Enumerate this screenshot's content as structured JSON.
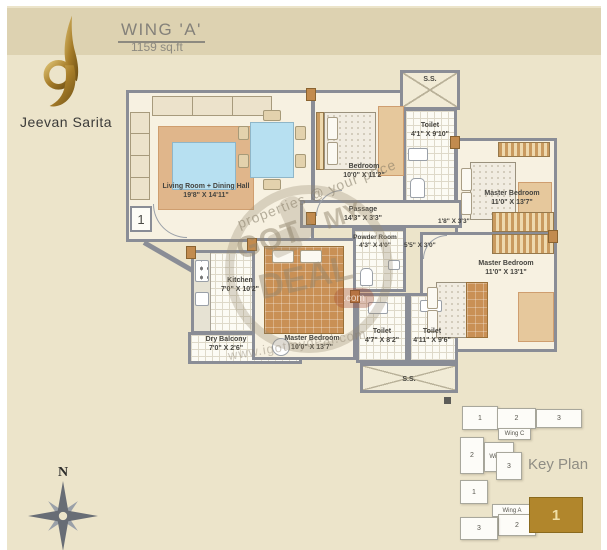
{
  "header": {
    "wing_title": "WING 'A'",
    "area": "1159 sq.ft"
  },
  "brand": {
    "name": "Jeevan Sarita"
  },
  "plan": {
    "rooms": [
      {
        "name": "Living Room + Dining Hall",
        "dims": "19'8\" X 14'11\""
      },
      {
        "name": "Bedroom",
        "dims": "10'0\" X 11'2\""
      },
      {
        "name": "Toilet",
        "dims": "4'1\" X 9'10\""
      },
      {
        "name": "Master Bedroom",
        "dims": "11'0\" X 13'7\""
      },
      {
        "name": "Passage",
        "dims": "14'3\" X 3'3\""
      },
      {
        "name": "Master Bedroom",
        "dims": "11'0\" X 13'1\""
      },
      {
        "name": "Powder Room",
        "dims": "4'3\" X 4'0\""
      },
      {
        "name": "Kitchen",
        "dims": "7'0\" X 10'2\""
      },
      {
        "name": "Dry Balcony",
        "dims": "7'0\" X 2'6\""
      },
      {
        "name": "Master Bedroom",
        "dims": "10'0\" X 13'7\""
      },
      {
        "name": "Toilet",
        "dims": "4'7\" X 8'2\""
      },
      {
        "name": "Toilet",
        "dims": "4'11\" X 9'6\""
      }
    ],
    "shafts": {
      "top": "S.S.",
      "bottom": "S.S."
    },
    "entrance_number": "1",
    "extra_dims": [
      "1'8\" X 3'3\"",
      "5'5\" X 3'0\""
    ]
  },
  "compass": {
    "north": "N"
  },
  "key_plan": {
    "title": "Key Plan",
    "blocks": [
      {
        "label": "1"
      },
      {
        "label": "2"
      },
      {
        "label": "3"
      },
      {
        "label": "Wing C"
      },
      {
        "label": "2"
      },
      {
        "label": "Wing B"
      },
      {
        "label": "3"
      },
      {
        "label": "1"
      },
      {
        "label": "Wing A"
      },
      {
        "label": "2"
      },
      {
        "label": "3"
      }
    ],
    "highlight": {
      "label": "1"
    }
  },
  "watermark": {
    "diagonal_text": "properties @ your price",
    "diagonal_text2": "www.igotmydeal.com",
    "stamp_words": {
      "w1": "GOT",
      "w2": "MY",
      "w3": "DEAL",
      "w4": ".com"
    }
  },
  "colors": {
    "background": "#ece4ca",
    "band": "#ddd2b1",
    "wall": "#8a8d96",
    "gold": "#b1862c"
  }
}
